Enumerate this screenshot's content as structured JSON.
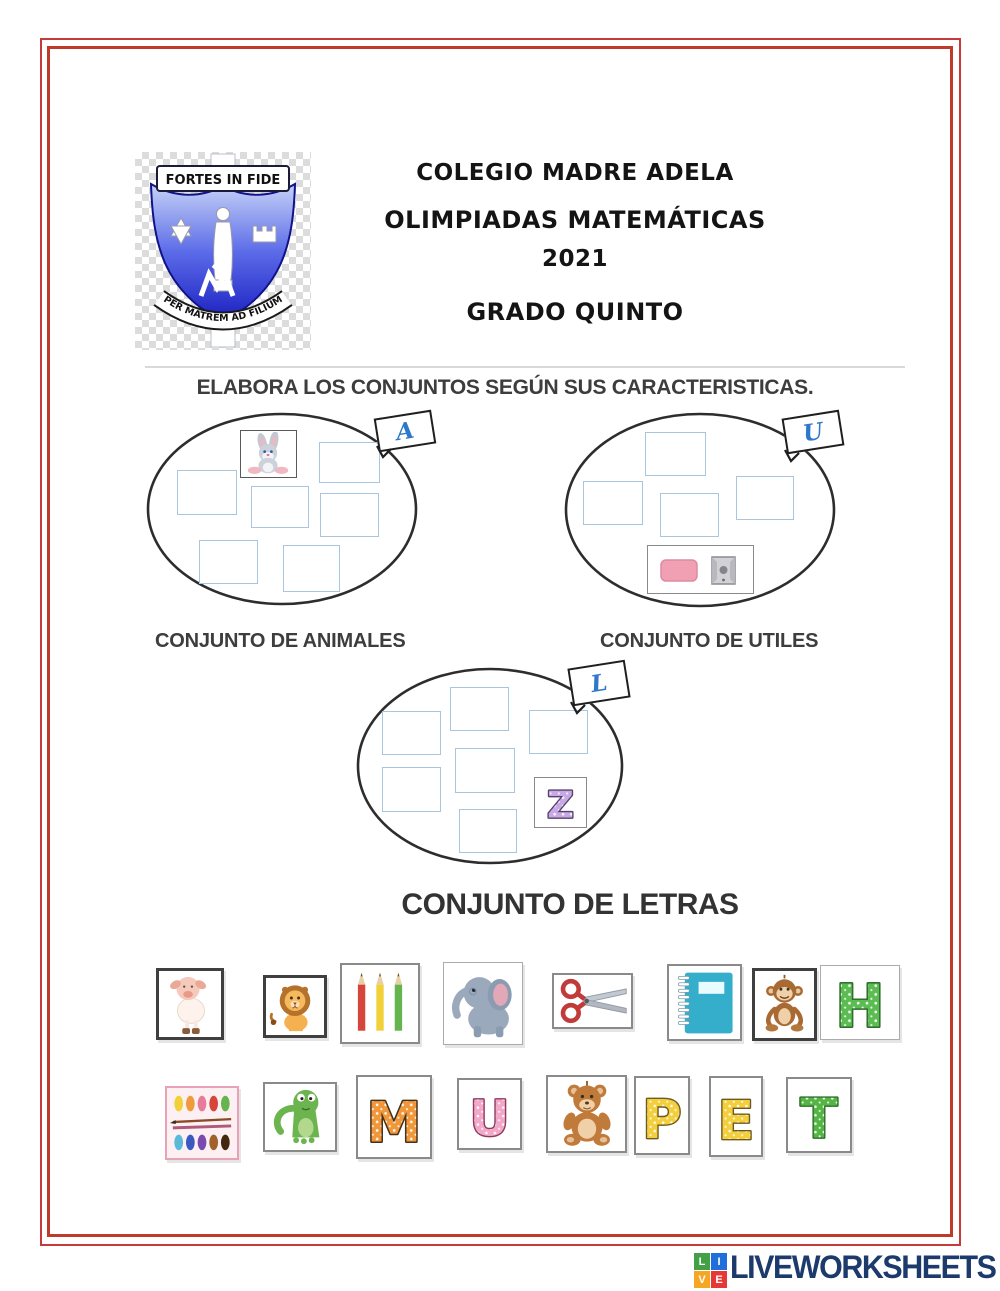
{
  "page": {
    "background": "#ffffff",
    "border_color": "#c0392b"
  },
  "header": {
    "school": "COLEGIO MADRE ADELA",
    "event": "OLIMPIADAS MATEMÁTICAS",
    "year": "2021",
    "grade": "GRADO QUINTO",
    "crest": {
      "motto_top": "FORTES IN FIDE",
      "motto_bottom": "PER MATREM AD FILIUM",
      "shield_color_top": "#c6d2f7",
      "shield_color_bottom": "#1a1fc0"
    }
  },
  "instruction": "ELABORA LOS CONJUNTOS SEGÚN SUS CARACTERISTICAS.",
  "sets": [
    {
      "tag_letter": "A",
      "label": "CONJUNTO DE ANIMALES",
      "example_item": "rabbit",
      "empty_slots": 6
    },
    {
      "tag_letter": "U",
      "label": "CONJUNTO DE UTILES",
      "example_item": "eraser-and-sharpener",
      "empty_slots": 4
    },
    {
      "tag_letter": "L",
      "label": "CONJUNTO DE LETRAS",
      "example_item": "letter-z",
      "empty_slots": 6
    }
  ],
  "letters": {
    "z": {
      "glyph": "Z",
      "fill": "#c9a8e6",
      "stroke": "#55436b"
    },
    "h": {
      "glyph": "H",
      "fill": "#5bbc52",
      "stroke": "#2e6f2a"
    },
    "m": {
      "glyph": "M",
      "fill": "#f0973a",
      "stroke": "#47301a"
    },
    "u": {
      "glyph": "U",
      "fill": "#f2a8c8",
      "stroke": "#8e3a5e"
    },
    "p": {
      "glyph": "P",
      "fill": "#f3cf3d",
      "stroke": "#6e5a1e"
    },
    "e": {
      "glyph": "E",
      "fill": "#f3cf3d",
      "stroke": "#6e5a1e"
    },
    "t": {
      "glyph": "T",
      "fill": "#54b545",
      "stroke": "#2e6f2a"
    }
  },
  "draggables": {
    "row1": [
      "pig",
      "lion",
      "colored-pencils",
      "elephant",
      "scissors",
      "notebook",
      "monkey",
      "letter-h"
    ],
    "row2": [
      "paint-palette",
      "green-monster",
      "letter-m",
      "letter-u",
      "teddy-bear",
      "letter-p",
      "letter-e",
      "letter-t"
    ]
  },
  "footer": {
    "brand": "LIVEWORKSHEETS",
    "brand_color": "#1c3a6b",
    "logo_tiles": [
      {
        "letter": "L",
        "color": "#43a047"
      },
      {
        "letter": "I",
        "color": "#1e6fd9"
      },
      {
        "letter": "V",
        "color": "#f5a623"
      },
      {
        "letter": "E",
        "color": "#e53935"
      }
    ]
  }
}
